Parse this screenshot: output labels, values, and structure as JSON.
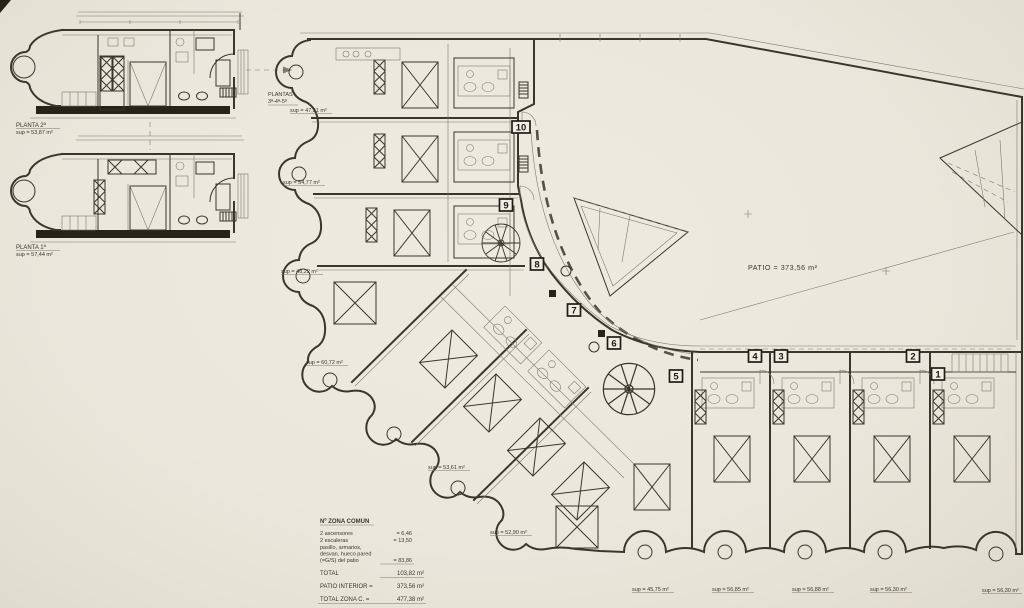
{
  "detail_units": {
    "upper": {
      "name": "PLANTA 2ª",
      "area": "sup = 53,87 m²"
    },
    "lower": {
      "name": "PLANTA 1ª",
      "area": "sup = 57,44 m²"
    }
  },
  "floors_note": {
    "line1": "PLANTAS",
    "line2": "3ª-4ª-5ª"
  },
  "patio": {
    "label": "PATIO = 373,56 m²"
  },
  "unit_numbers": {
    "n1": "1",
    "n2": "2",
    "n3": "3",
    "n4": "4",
    "n5": "5",
    "n6": "6",
    "n7": "7",
    "n8": "8",
    "n9": "9",
    "n10": "10"
  },
  "areas": {
    "a1": "sup = 47,51 m²",
    "a2": "sup = 54,77 m²",
    "a3": "sup = 48,22 m²",
    "a4": "sup = 60,72 m²",
    "a5": "sup = 53,61 m²",
    "a6": "sup = 52,90 m²",
    "a7": "sup = 45,75 m²",
    "a8": "sup = 56,85 m²",
    "a9": "sup = 56,88 m²",
    "a10": "sup = 56,30 m²",
    "a11": "sup = 56,30 m²"
  },
  "legend": {
    "title": "Nº ZONA COMUN",
    "row1_label": "2 ascensores",
    "row1_value": "=   6,46",
    "row2_label": "2 escaleras",
    "row2_value": "= 13,50",
    "row3_label": "pasillo, armarios,",
    "row4_label": "desvan, hueco pared",
    "row5_label": "(=G/S) del patio",
    "row5_value": "=  83,86",
    "total_label": "TOTAL",
    "total_value": "103,82  m²",
    "patio_label": "PATIO INTERIOR =",
    "patio_value": "373,56  m²",
    "zone_label": "TOTAL ZONA C. =",
    "zone_value": "477,38  m²"
  }
}
